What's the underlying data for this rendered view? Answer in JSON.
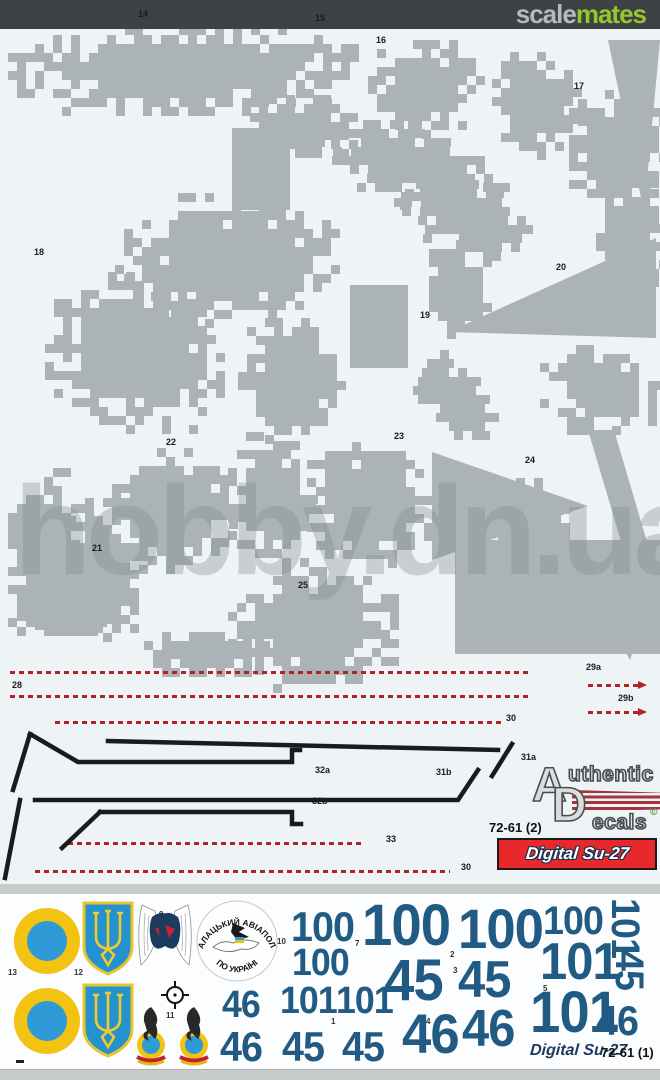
{
  "header": {
    "brand_gray": "scale",
    "brand_green": "mates"
  },
  "watermark": "hobby.dn.ua",
  "colors": {
    "camo_gray": "#abb3b6",
    "sheet_white": "#eef3f6",
    "photo_bg": "#c7cbcc",
    "stripe_red": "#b2222a",
    "badge_red": "#e8282b",
    "numeral_navy": "#215a82",
    "roundel_yellow": "#f2c411",
    "roundel_blue": "#2f9ad6",
    "brand_green": "#97c62b"
  },
  "sheet2": {
    "camo_labels": [
      {
        "t": "14",
        "x": 138,
        "y": 10
      },
      {
        "t": "15",
        "x": 315,
        "y": 14
      },
      {
        "t": "16",
        "x": 376,
        "y": 36
      },
      {
        "t": "17",
        "x": 574,
        "y": 82
      },
      {
        "t": "18",
        "x": 34,
        "y": 248
      },
      {
        "t": "19",
        "x": 420,
        "y": 311
      },
      {
        "t": "20",
        "x": 556,
        "y": 263
      },
      {
        "t": "21",
        "x": 92,
        "y": 544
      },
      {
        "t": "22",
        "x": 166,
        "y": 438
      },
      {
        "t": "23",
        "x": 394,
        "y": 432
      },
      {
        "t": "24",
        "x": 525,
        "y": 456
      },
      {
        "t": "25",
        "x": 298,
        "y": 581
      }
    ],
    "stripe_labels": [
      {
        "t": "28",
        "x": 12,
        "y": 681
      },
      {
        "t": "29a",
        "x": 586,
        "y": 663
      },
      {
        "t": "29b",
        "x": 618,
        "y": 694
      },
      {
        "t": "30",
        "x": 506,
        "y": 714
      },
      {
        "t": "31a",
        "x": 521,
        "y": 753
      },
      {
        "t": "32a",
        "x": 315,
        "y": 766
      },
      {
        "t": "31b",
        "x": 436,
        "y": 768
      },
      {
        "t": "32b",
        "x": 312,
        "y": 797
      },
      {
        "t": "33",
        "x": 386,
        "y": 835
      },
      {
        "t": "30",
        "x": 461,
        "y": 863
      }
    ],
    "catalog": "72-61 (2)",
    "badge": "Digital Su-27",
    "logo": {
      "a": "A",
      "uthentic": "uthentic",
      "d": "D",
      "ecals": "ecals",
      "copy": "©"
    }
  },
  "sheet1": {
    "item_labels": [
      {
        "t": "9",
        "x": 159,
        "y": 911
      },
      {
        "t": "10",
        "x": 277,
        "y": 938
      },
      {
        "t": "11",
        "x": 166,
        "y": 1012
      },
      {
        "t": "12",
        "x": 74,
        "y": 969
      },
      {
        "t": "13",
        "x": 8,
        "y": 969
      },
      {
        "t": "7",
        "x": 355,
        "y": 940
      },
      {
        "t": "2",
        "x": 450,
        "y": 951
      },
      {
        "t": "3",
        "x": 453,
        "y": 967
      },
      {
        "t": "4",
        "x": 426,
        "y": 1018
      },
      {
        "t": "5",
        "x": 543,
        "y": 985
      },
      {
        "t": "1",
        "x": 331,
        "y": 1018
      }
    ],
    "emblem_text": {
      "top": "ГАЛАЦЬКИЙ АВІАПОЛК",
      "bottom": "ПО УКРАЇНІ"
    },
    "numerals": [
      {
        "t": "100",
        "x": 291,
        "y": 906,
        "fs": 42
      },
      {
        "t": "100",
        "x": 292,
        "y": 944,
        "fs": 38
      },
      {
        "t": "101",
        "x": 280,
        "y": 982,
        "fs": 38
      },
      {
        "t": "101",
        "x": 336,
        "y": 982,
        "fs": 38
      },
      {
        "t": "46",
        "x": 222,
        "y": 986,
        "fs": 38
      },
      {
        "t": "46",
        "x": 220,
        "y": 1026,
        "fs": 42
      },
      {
        "t": "45",
        "x": 282,
        "y": 1026,
        "fs": 42
      },
      {
        "t": "45",
        "x": 342,
        "y": 1026,
        "fs": 42
      },
      {
        "t": "100",
        "x": 362,
        "y": 897,
        "fs": 58
      },
      {
        "t": "45",
        "x": 384,
        "y": 952,
        "fs": 58
      },
      {
        "t": "46",
        "x": 402,
        "y": 1006,
        "fs": 56
      },
      {
        "t": "100",
        "x": 458,
        "y": 901,
        "fs": 56
      },
      {
        "t": "45",
        "x": 458,
        "y": 954,
        "fs": 52
      },
      {
        "t": "46",
        "x": 462,
        "y": 1003,
        "fs": 52
      },
      {
        "t": "100",
        "x": 543,
        "y": 901,
        "fs": 40
      },
      {
        "t": "101",
        "x": 540,
        "y": 936,
        "fs": 52
      },
      {
        "t": "101",
        "x": 530,
        "y": 984,
        "fs": 58
      },
      {
        "t": "46",
        "x": 596,
        "y": 1000,
        "fs": 42
      },
      {
        "t": "101",
        "x": 614,
        "y": 898,
        "fs": 40,
        "rot": 90
      },
      {
        "t": "45",
        "x": 618,
        "y": 950,
        "fs": 40,
        "rot": 90
      }
    ],
    "footer_title": "Digital Su-27",
    "footer_catalog": "72-61 (1)"
  }
}
